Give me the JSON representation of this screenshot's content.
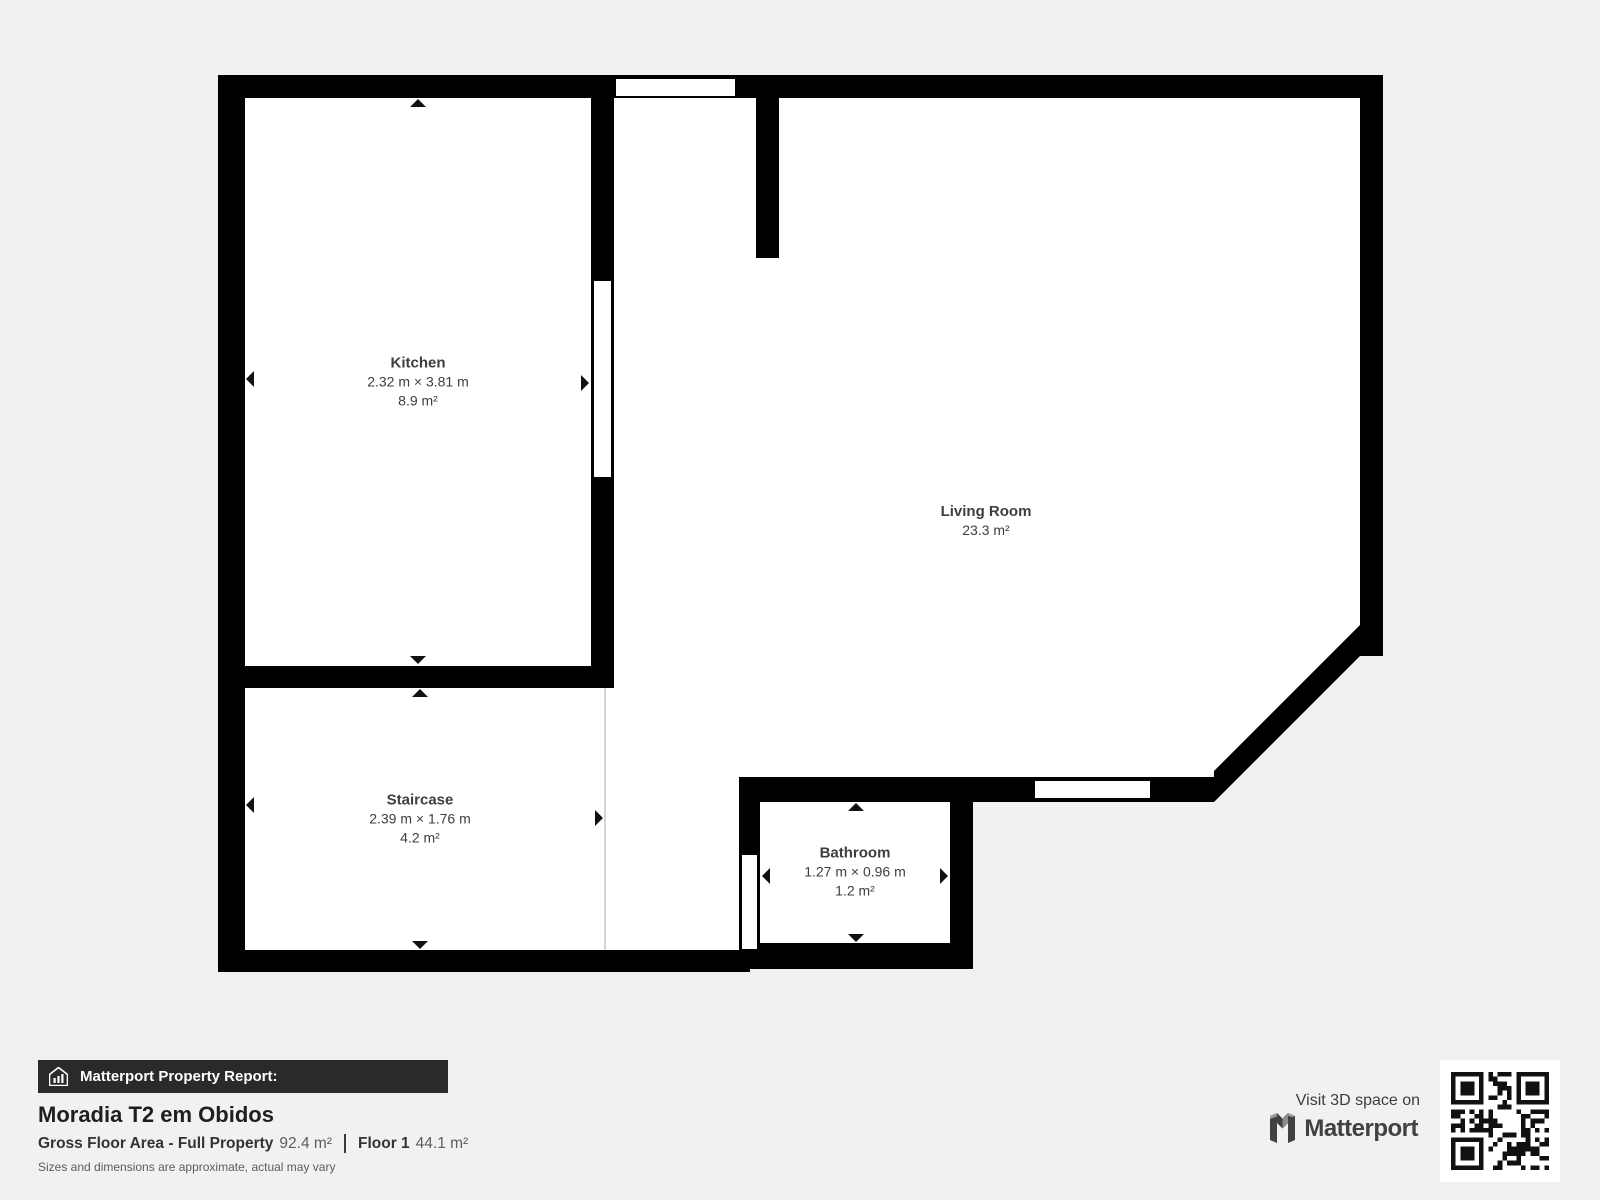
{
  "plan": {
    "rooms": [
      {
        "id": "kitchen",
        "name": "Kitchen",
        "dimensions": "2.32 m × 3.81 m",
        "area": "8.9 m²"
      },
      {
        "id": "living-room",
        "name": "Living Room",
        "dimensions": "",
        "area": "23.3 m²"
      },
      {
        "id": "staircase",
        "name": "Staircase",
        "dimensions": "2.39 m × 1.76 m",
        "area": "4.2 m²"
      },
      {
        "id": "bathroom",
        "name": "Bathroom",
        "dimensions": "1.27 m × 0.96 m",
        "area": "1.2 m²"
      }
    ]
  },
  "footer": {
    "report_label": "Matterport Property Report:",
    "property_name": "Moradia T2 em Obidos",
    "gross_floor_area_label": "Gross Floor Area - Full Property",
    "gross_floor_area_value": "92.4 m²",
    "floor_label": "Floor 1",
    "floor_value": "44.1 m²",
    "disclaimer": "Sizes and dimensions are approximate, actual may vary",
    "visit_label": "Visit 3D space on",
    "brand": "Matterport"
  },
  "colors": {
    "background": "#f2f1ef",
    "wall": "#000000",
    "room_fill": "#ffffff",
    "label_text": "#3e3e3e",
    "bar_background": "#2a2a2a",
    "divider_line": "#d4d4d4"
  }
}
